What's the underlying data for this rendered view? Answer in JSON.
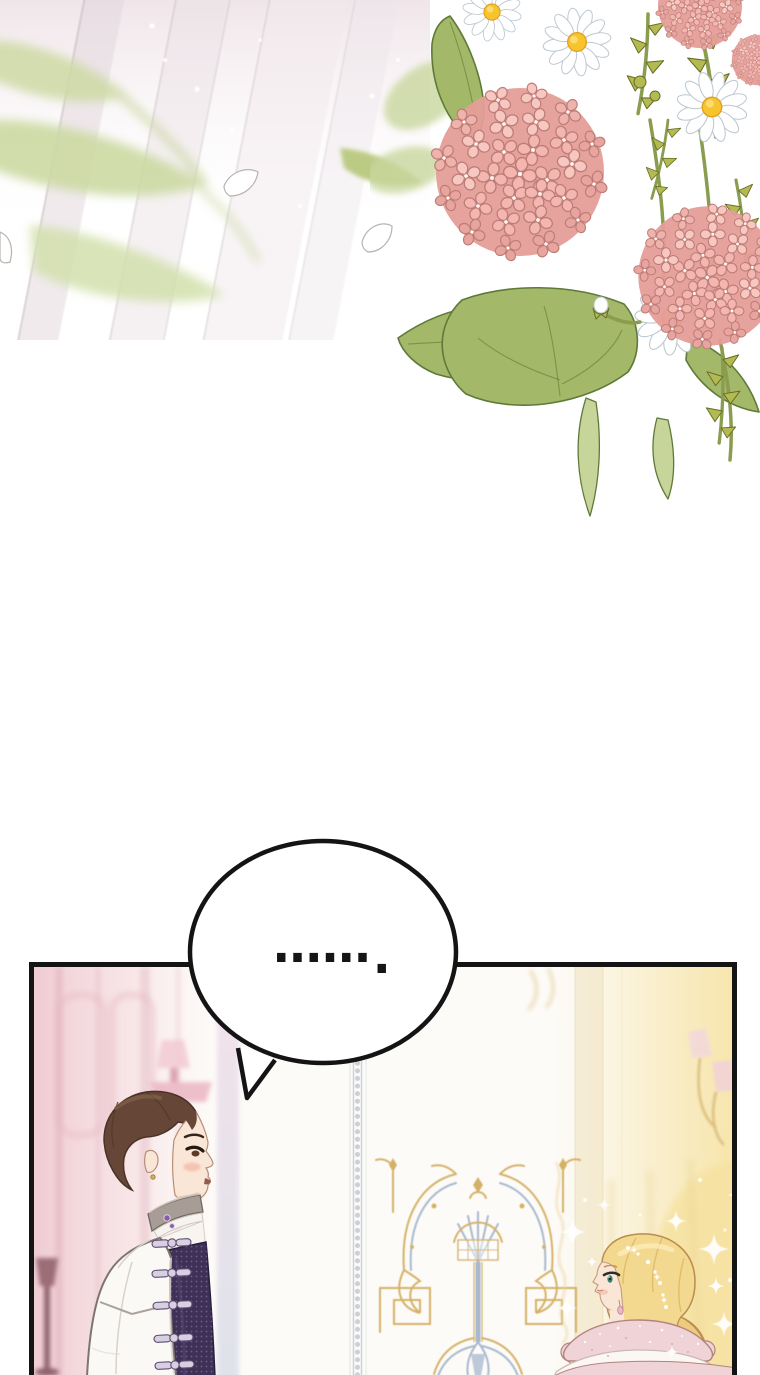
{
  "page": {
    "kind": "webtoon-comic-page",
    "width_px": 760,
    "height_px": 1375,
    "background": "#ffffff"
  },
  "speech_bubble": {
    "text": "......",
    "trailing_period": ".",
    "shape": "ellipse-with-tail-pointing-down-left"
  },
  "scene": {
    "top_left_decor": [
      "diagonal-sunlight-rays",
      "blurred-green-leaves",
      "falling-petal-outlines",
      "sparkle-dots"
    ],
    "top_right_bouquet": [
      "pink-hydrangea-bloom-large",
      "pink-hydrangea-bloom-right",
      "pink-hydrangea-corner-cluster",
      "white-daisies",
      "daisy-bud",
      "green-leaves",
      "spiky-yellow-green-foliage"
    ],
    "panel": {
      "setting": "ornate-palace-interior",
      "left_background": [
        "pink-wall-panels",
        "pink-wall-sconce",
        "dark-mauve-floor-lamp",
        "lilac-wall-stripe"
      ],
      "center_background": [
        "beaded-pillar-trim",
        "gold-and-blue-baroque-wall-ornament"
      ],
      "right_background": [
        "cream-pillar-band",
        "wall-sconce-with-pink-shades",
        "warm-yellow-light-glow",
        "gold-filigree-column",
        "sparkles",
        "light-dust"
      ],
      "characters": [
        {
          "id": "man",
          "facing": "right",
          "features": [
            "short-brown-hair",
            "earring",
            "blush",
            "gray-high-collar",
            "purple-gem-collar-clasp",
            "white-coat",
            "dark-purple-patterned-vest",
            "silver-frog-clasps"
          ]
        },
        {
          "id": "woman",
          "facing": "left",
          "features": [
            "blonde-hair",
            "jeweled-hairpins",
            "teal-eye",
            "blush",
            "drop-earring",
            "pink-ruffled-tiered-dress",
            "puff-sleeves"
          ]
        }
      ]
    }
  },
  "colors": {
    "page-bg": "#ffffff",
    "ink": "#141414",
    "hyd-pink": "#f3b6b0",
    "hyd-pink-dark": "#e59d98",
    "hyd-pink-light": "#f9d3cc",
    "hyd-outline": "#bd7d76",
    "daisy-white": "#ffffff",
    "daisy-shade": "#bcc8d2",
    "daisy-yellow": "#f6c42c",
    "daisy-yellow-deep": "#e2a01c",
    "leaf": "#a3b868",
    "leaf-dark": "#5f7a38",
    "leaf-light": "#c7d49a",
    "foliage": "#b4ba52",
    "foliage-dark": "#666d24",
    "stem": "#8a9c4e",
    "ray-pink": "#e9dde3",
    "wall-pink": "#f0cbd3",
    "wall-pink-deep": "#dfadbb",
    "sconce-pink": "#f0c3cf",
    "lamp-mauve": "#8d5b66",
    "bead-gray": "#c6cdd6",
    "cream": "#f3ead6",
    "glow": "#f6e3a4",
    "gold": "#d0aa58",
    "gold-light": "#e7cf96",
    "orn-blue": "#9fb2ca",
    "skin": "#f9e6d6",
    "skin-line": "#b98e78",
    "blush": "#f2a28e",
    "man-hair": "#664737",
    "man-hair-dark": "#4a3226",
    "man-hair-hi": "#8a6a50",
    "coat": "#fbf9f6",
    "coat-line": "#7d756e",
    "coat-shade": "#d9d2ca",
    "collar": "#a79d96",
    "collar-dark": "#6f6760",
    "vest": "#3f3156",
    "vest-dark": "#262040",
    "clasp": "#d9cfe3",
    "clasp-line": "#5c4c6e",
    "gem": "#8a5ca3",
    "woman-hair": "#f3d88f",
    "woman-hair-line": "#b98d4e",
    "woman-hair-shade": "#e0ba66",
    "woman-hair-hi": "#fbeebb",
    "eye-teal": "#3f7f74",
    "dress-pink": "#efd3d6",
    "dress-line": "#b2837c",
    "dress-white": "#fbf7f2",
    "sparkle": "#ffffff"
  }
}
